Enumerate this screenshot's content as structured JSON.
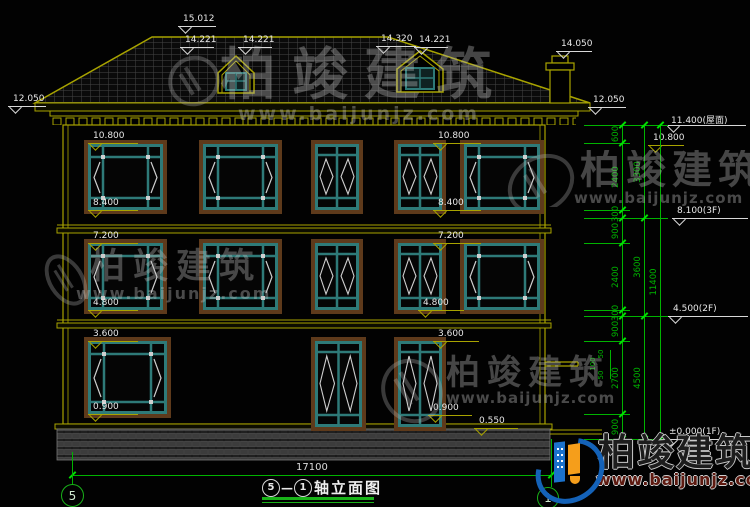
{
  "drawing": {
    "title": {
      "axis_a": "5",
      "sep": "—",
      "axis_b": "1",
      "name": "轴立面图"
    },
    "bottom_axes": [
      "5",
      "1"
    ],
    "overall_dim": "17100",
    "roof_markers": [
      {
        "t": "15.012",
        "lx": 178,
        "ly": 26,
        "lw": 38
      },
      {
        "t": "14.221",
        "lx": 180,
        "ly": 47,
        "lw": 34
      },
      {
        "t": "14.221",
        "lx": 238,
        "ly": 47,
        "lw": 34
      },
      {
        "t": "14.320",
        "lx": 376,
        "ly": 46,
        "lw": 40
      },
      {
        "t": "14.221",
        "lx": 414,
        "ly": 47,
        "lw": 34
      },
      {
        "t": "14.050",
        "lx": 556,
        "ly": 51,
        "lw": 36
      },
      {
        "t": "12.050",
        "lx": 8,
        "ly": 106,
        "lw": 38
      },
      {
        "t": "12.050",
        "lx": 588,
        "ly": 107,
        "lw": 38
      }
    ],
    "floor_markers": [
      {
        "t": "10.800",
        "lx": 88,
        "ly": 143,
        "lw": 50
      },
      {
        "t": "8.400",
        "lx": 88,
        "ly": 210,
        "lw": 50
      },
      {
        "t": "7.200",
        "lx": 88,
        "ly": 243,
        "lw": 50
      },
      {
        "t": "4.800",
        "lx": 88,
        "ly": 310,
        "lw": 50
      },
      {
        "t": "3.600",
        "lx": 88,
        "ly": 341,
        "lw": 50
      },
      {
        "t": "0.900",
        "lx": 88,
        "ly": 414,
        "lw": 50
      },
      {
        "t": "10.800",
        "lx": 433,
        "ly": 143,
        "lw": 48
      },
      {
        "t": "8.400",
        "lx": 433,
        "ly": 210,
        "lw": 48
      },
      {
        "t": "7.200",
        "lx": 433,
        "ly": 243,
        "lw": 48
      },
      {
        "t": "4.800",
        "lx": 418,
        "ly": 310,
        "lw": 46
      },
      {
        "t": "3.600",
        "lx": 433,
        "ly": 341,
        "lw": 46
      },
      {
        "t": "0.900",
        "lx": 428,
        "ly": 415,
        "lw": 44
      },
      {
        "t": "0.550",
        "lx": 474,
        "ly": 428,
        "lw": 44
      },
      {
        "t": "10.800",
        "lx": 648,
        "ly": 145,
        "lw": 36
      }
    ],
    "level_markers": [
      {
        "t": "11.400(屋面)",
        "lx": 666,
        "ly": 125,
        "lw": 80
      },
      {
        "t": "8.100(3F)",
        "lx": 672,
        "ly": 218,
        "lw": 76
      },
      {
        "t": "4.500(2F)",
        "lx": 668,
        "ly": 316,
        "lw": 80
      },
      {
        "t": "±0.000(1F)",
        "lx": 664,
        "ly": 439,
        "lw": 84
      }
    ],
    "dims": {
      "chain1": [
        {
          "t": "600",
          "y1": 125,
          "y2": 143
        },
        {
          "t": "2400",
          "y1": 143,
          "y2": 210
        },
        {
          "t": "300",
          "y1": 210,
          "y2": 218
        },
        {
          "t": "900",
          "y1": 218,
          "y2": 243
        },
        {
          "t": "2400",
          "y1": 243,
          "y2": 310
        },
        {
          "t": "300",
          "y1": 310,
          "y2": 316
        },
        {
          "t": "900",
          "y1": 316,
          "y2": 341
        },
        {
          "t": "2700",
          "y1": 341,
          "y2": 414
        },
        {
          "t": "900",
          "y1": 414,
          "y2": 439
        }
      ],
      "chain2": [
        {
          "t": "3300",
          "y1": 125,
          "y2": 218
        },
        {
          "t": "3600",
          "y1": 218,
          "y2": 316
        },
        {
          "t": "4500",
          "y1": 316,
          "y2": 439
        }
      ],
      "chain3": [
        {
          "t": "11400",
          "y1": 125,
          "y2": 439
        }
      ],
      "pipe_dims": [
        "50",
        "100",
        "50"
      ]
    },
    "watermark": {
      "brand": "柏竣建筑",
      "url": "www.baijunjz.com"
    }
  },
  "windows": [
    {
      "x": 88,
      "y": 144,
      "w": 75,
      "h": 66,
      "t": "wide"
    },
    {
      "x": 203,
      "y": 144,
      "w": 75,
      "h": 66,
      "t": "wide"
    },
    {
      "x": 315,
      "y": 144,
      "w": 44,
      "h": 66,
      "t": "narrow"
    },
    {
      "x": 398,
      "y": 144,
      "w": 44,
      "h": 66,
      "t": "narrow"
    },
    {
      "x": 464,
      "y": 144,
      "w": 76,
      "h": 66,
      "t": "wide"
    },
    {
      "x": 88,
      "y": 243,
      "w": 75,
      "h": 67,
      "t": "wide"
    },
    {
      "x": 203,
      "y": 243,
      "w": 75,
      "h": 67,
      "t": "wide"
    },
    {
      "x": 315,
      "y": 243,
      "w": 44,
      "h": 67,
      "t": "narrow"
    },
    {
      "x": 398,
      "y": 243,
      "w": 44,
      "h": 67,
      "t": "narrow"
    },
    {
      "x": 464,
      "y": 243,
      "w": 76,
      "h": 67,
      "t": "wide"
    },
    {
      "x": 88,
      "y": 341,
      "w": 79,
      "h": 73,
      "t": "wide"
    },
    {
      "x": 315,
      "y": 341,
      "w": 47,
      "h": 86,
      "t": "narrow"
    },
    {
      "x": 398,
      "y": 341,
      "w": 44,
      "h": 86,
      "t": "narrow"
    }
  ],
  "colors": {
    "line": "#a8a300",
    "dim": "#00b300",
    "tick": "#00e000",
    "text": "#e8e8e8",
    "teal": "#2e7a78",
    "frame": "#5e3a1b",
    "white_line": "#cfcfcf"
  }
}
